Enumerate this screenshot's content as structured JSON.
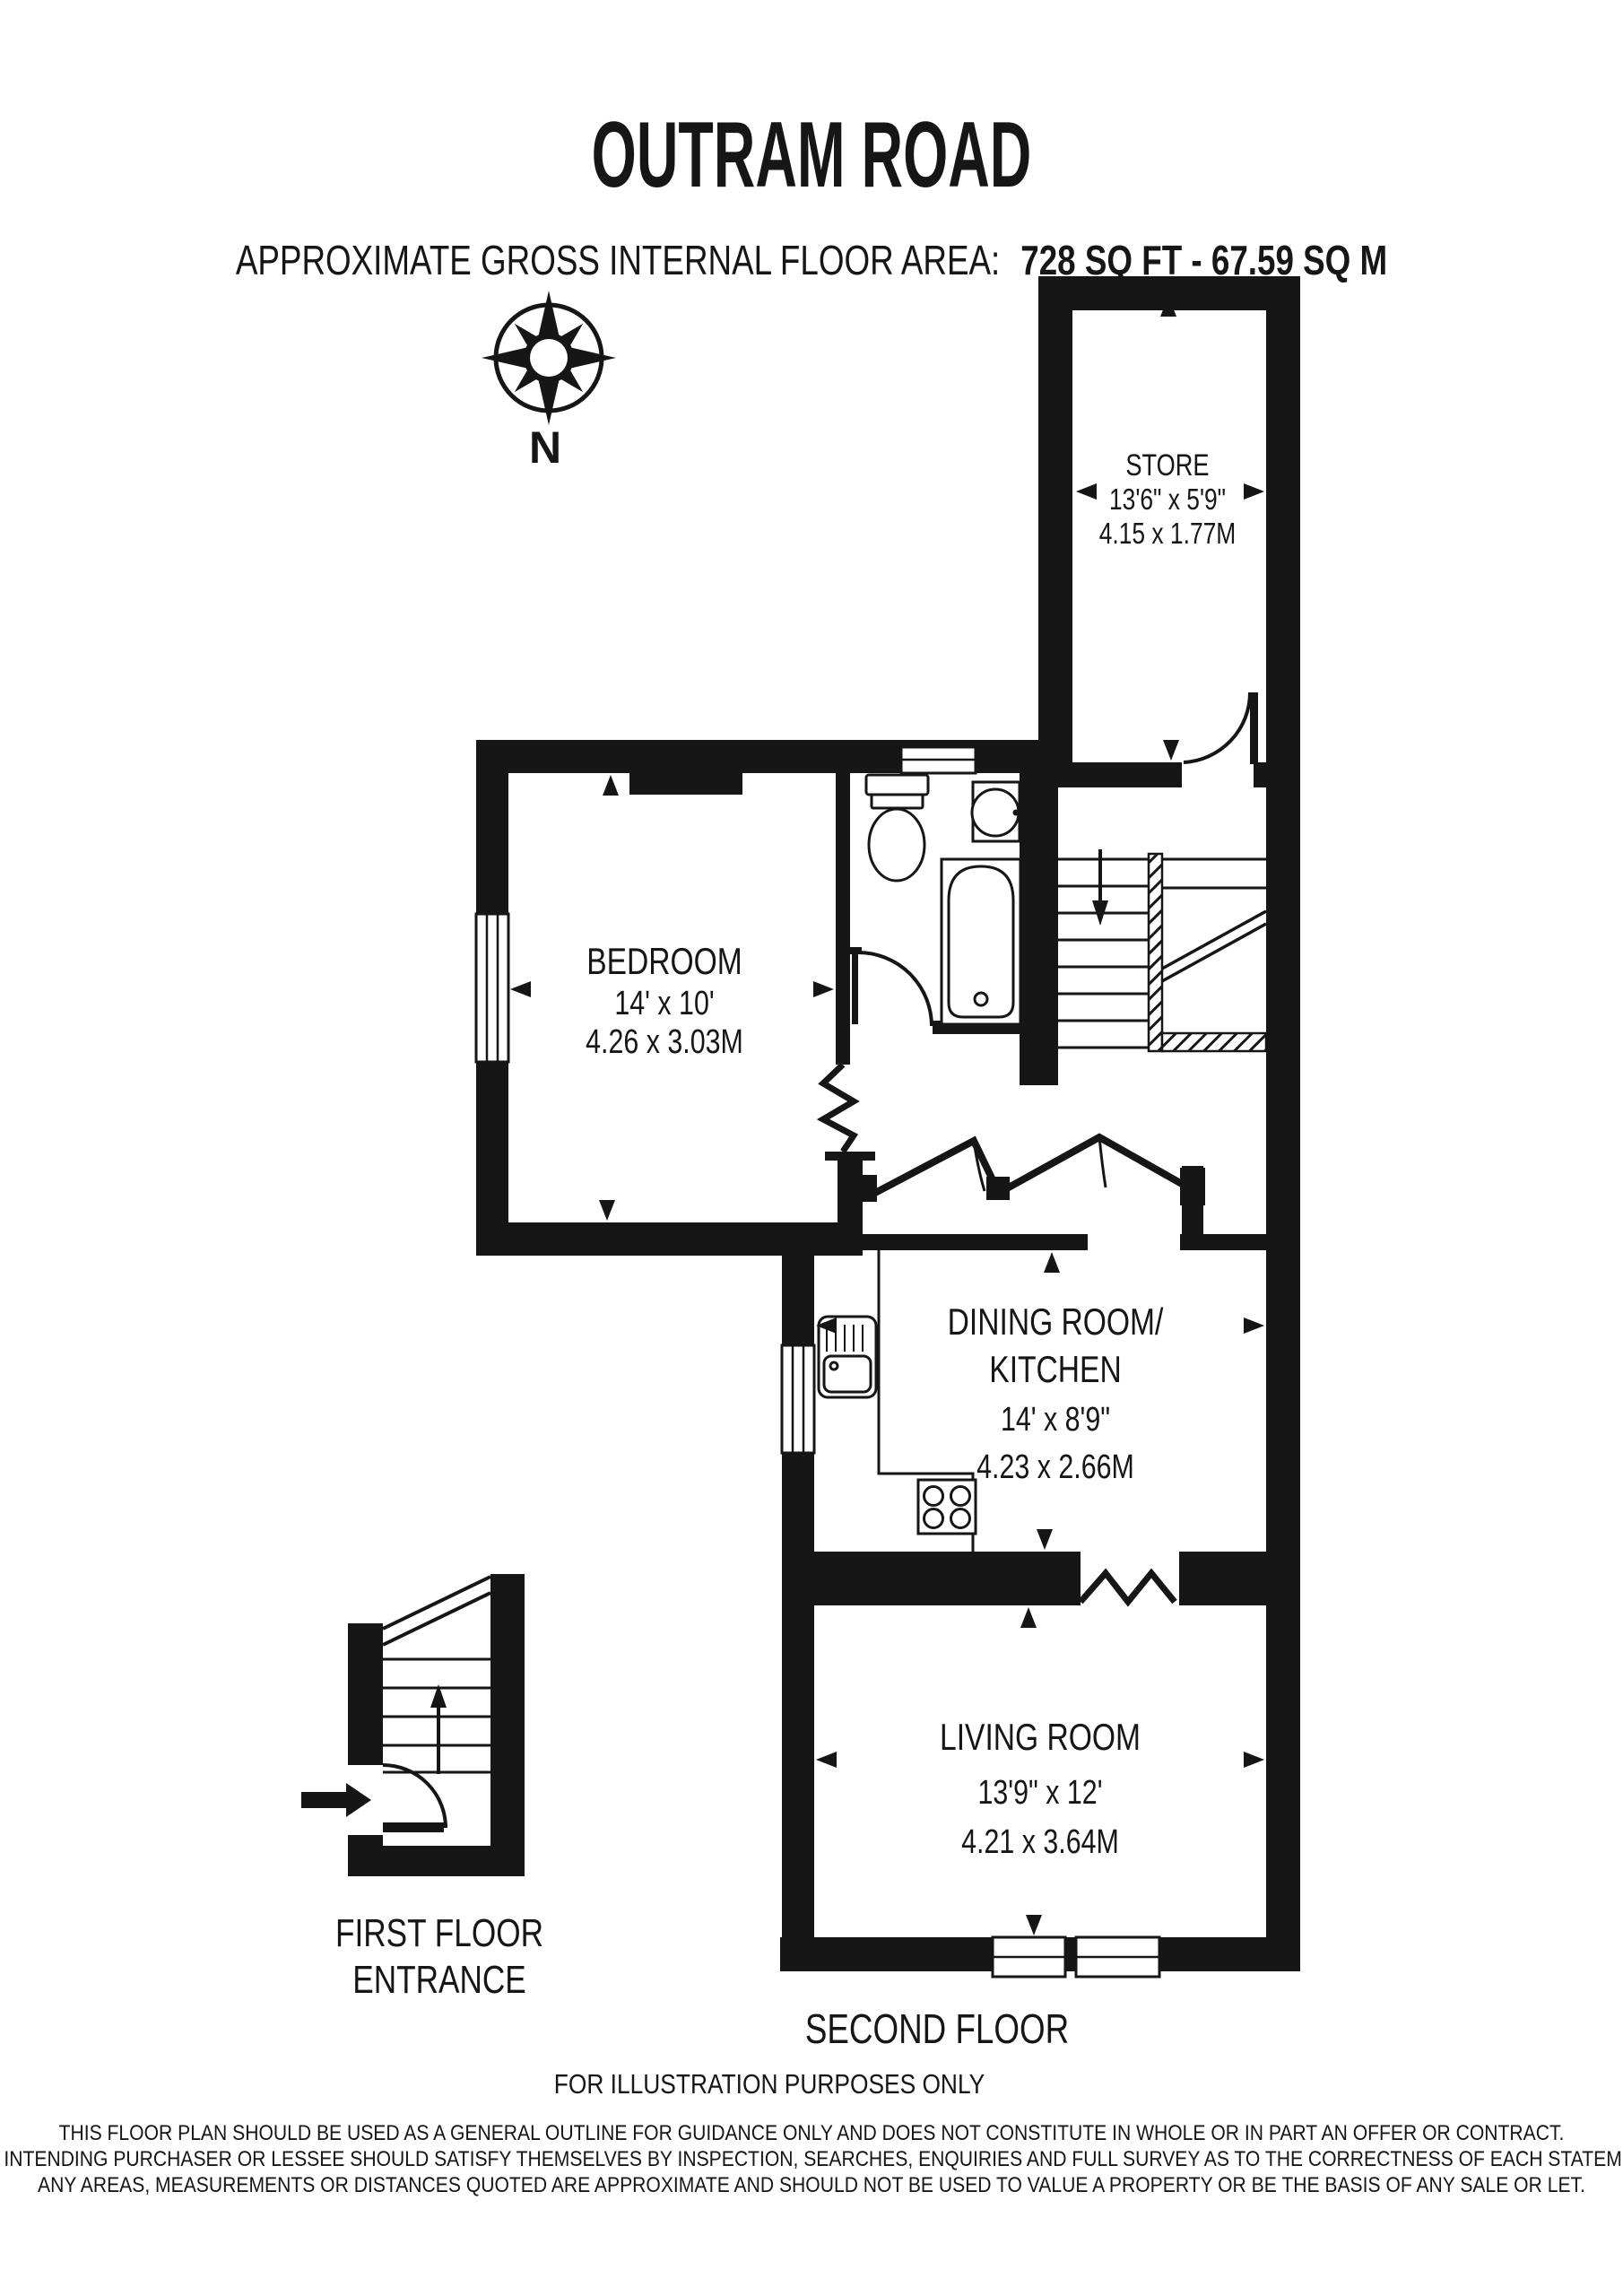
{
  "colors": {
    "wall": "#161616",
    "background": "#ffffff"
  },
  "header": {
    "title": "OUTRAM ROAD",
    "subtitle_prefix": "APPROXIMATE GROSS INTERNAL FLOOR AREA:",
    "subtitle_value": "728 SQ FT - 67.59 SQ M"
  },
  "compass": {
    "label": "N"
  },
  "rooms": {
    "store": {
      "name": "STORE",
      "imperial": "13'6\" x 5'9\"",
      "metric": "4.15 x 1.77M"
    },
    "bedroom": {
      "name": "BEDROOM",
      "imperial": "14' x 10'",
      "metric": "4.26 x 3.03M"
    },
    "dining": {
      "name_line1": "DINING ROOM/",
      "name_line2": "KITCHEN",
      "imperial": "14' x 8'9\"",
      "metric": "4.23 x 2.66M"
    },
    "living": {
      "name": "LIVING ROOM",
      "imperial": "13'9\" x 12'",
      "metric": "4.21 x 3.64M"
    }
  },
  "footer": {
    "first_floor_line1": "FIRST FLOOR",
    "first_floor_line2": "ENTRANCE",
    "floor_label": "SECOND FLOOR",
    "illustration": "FOR ILLUSTRATION PURPOSES ONLY"
  },
  "disclaimer": {
    "line1": "THIS FLOOR PLAN SHOULD BE USED AS A GENERAL OUTLINE FOR GUIDANCE ONLY AND DOES NOT CONSTITUTE IN WHOLE OR IN PART AN OFFER OR CONTRACT.",
    "line2": "ANY INTENDING PURCHASER OR LESSEE SHOULD SATISFY THEMSELVES BY INSPECTION, SEARCHES, ENQUIRIES AND FULL SURVEY AS TO THE CORRECTNESS OF EACH STATEMENT.",
    "line3": "ANY AREAS, MEASUREMENTS OR DISTANCES QUOTED ARE APPROXIMATE AND SHOULD NOT BE USED TO VALUE A PROPERTY OR BE THE BASIS OF ANY SALE OR LET."
  }
}
